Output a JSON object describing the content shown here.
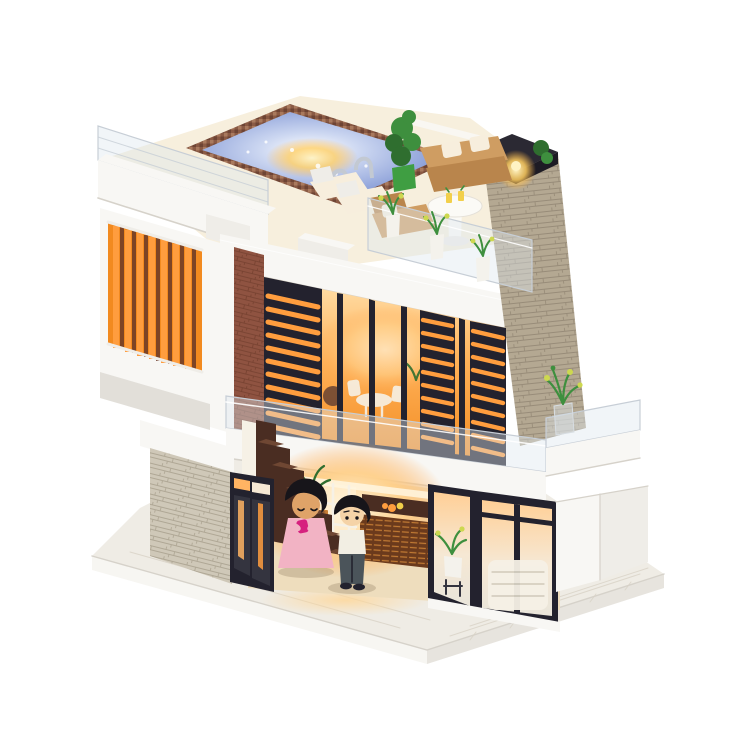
{
  "scene": {
    "alt": "DIY miniature dollhouse model: modern two-story villa with rooftop swimming pool, terrace furniture, orange slat balcony screen, stone chimney, warm lit glass facade, staircase and two figurines on a white wooden base",
    "background": "#ffffff"
  },
  "objects": [
    "rooftop-pool",
    "pool-tile-rim",
    "pool-ladder",
    "roof-terrace-deck",
    "acrylic-railing",
    "white-parapet",
    "planter-box",
    "lounge-chair",
    "topiary-plant",
    "outdoor-sofa",
    "throw-pillow",
    "pedestal-table",
    "lemonade-glass",
    "floor-lamp",
    "stone-chimney",
    "chimney-cap",
    "orange-slat-screen",
    "white-column",
    "brick-pillar",
    "louver-panel",
    "glass-curtain-wall",
    "window-mullion",
    "balcony-band",
    "balcony-plant",
    "stone-veneer-wall",
    "glass-door",
    "staircase",
    "interior-shelf",
    "rattan-cabinet",
    "fruit-bowl",
    "girl-figurine",
    "boy-figurine",
    "corner-window",
    "wicker-sofa",
    "potted-plant",
    "white-side-wall",
    "white-base-platform"
  ],
  "palette": {
    "bg": "#ffffff",
    "white": "#f8f7f4",
    "white_soft": "#efede8",
    "white_shade": "#e2dfd9",
    "edge_line": "#d6d2ca",
    "cream_deck": "#f7efdd",
    "acrylic_fill": "rgba(222,230,238,0.42)",
    "acrylic_edge": "#c7ced6",
    "stone_chimney": "#b4a892",
    "stone_line": "#8f8370",
    "stone_light": "#cfc8b8",
    "stone_light_line": "#a89f8c",
    "brick": "#8f5341",
    "brick_line": "#693727",
    "cap_dark": "#2b2933",
    "cap_side": "#1d1b24",
    "frame_dark": "#23222e",
    "louver_glow": "#ff9d3e",
    "glass_dark": "#34343f",
    "glass_top": "#ffe2ae",
    "glass_mid": "#ffb158",
    "glass_deep": "#f28a1f",
    "glass_low_top": "#ffd9a4",
    "glass_low_mid": "#ffb463",
    "glass_low_bot": "#ffd29b",
    "win_top": "#ffcf96",
    "win_mid": "#f6e8d4",
    "win_bot": "#e9e5da",
    "white_pure": "#ffffff",
    "pool_pale": "#ccd7f1",
    "pool_mid": "#8b9fd8",
    "pool_deep": "#7288c6",
    "tile_a": "#8a5a44",
    "tile_b": "#a97a5e",
    "tile_c": "#6e4434",
    "chrome": "#c3c9d2",
    "sofa_tan": "#cf9d62",
    "sofa_tan_dark": "#b9854c",
    "pillow": "#f7eedd",
    "table_white": "#fbfaf6",
    "lemon": "#f2cf4a",
    "plant_green": "#3e8f3e",
    "plant_dark": "#2f6e2f",
    "plant_yellow": "#cdd84f",
    "pot_green": "#3f9e42",
    "pot_white": "#f4f2ec",
    "stair_dark": "#4a2d22",
    "stair_face": "#6f4733",
    "wood_floor": "#eeddbd",
    "cabinet": "#6b3a1c",
    "cabinet_line": "#c97f35",
    "shelf_white": "#f6f1e6",
    "hair": "#17151a",
    "skin_girl": "#dfa368",
    "skin_boy": "#f5d3a7",
    "dress_pink": "#f2b3c4",
    "magenta": "#d6217e",
    "shirt": "#f2eee3",
    "pants": "#4b545a",
    "base_top": "#efece5",
    "base_side": "#f7f6f2",
    "base_side2": "#e7e4de",
    "plank_line": "#d8d2c5",
    "glow_mid": "#ffd08a",
    "glow_core": "#fff6e0",
    "glow_fade": "rgba(255,166,77,0)",
    "lamp_core": "#fff3c4",
    "lamp_mid": "rgba(255,205,95,0.85)",
    "lamp_fade": "rgba(255,180,70,0)",
    "spill": "rgba(255,214,150,0.8)",
    "spill_fade": "rgba(255,214,150,0)",
    "shadow_soft": "rgba(120,100,70,0.25)"
  }
}
